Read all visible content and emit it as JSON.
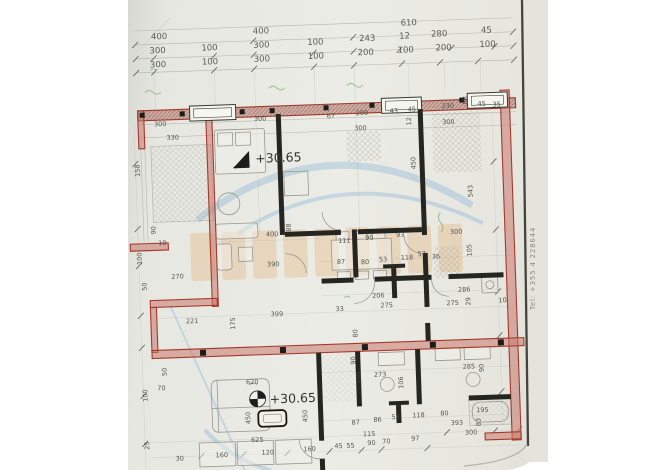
{
  "margin_note": {
    "text": "Tel: +355 4 228644"
  },
  "colors": {
    "wall_red": "#a4392c",
    "wall_black": "#262621",
    "paper": "#e9e9e3",
    "watermark_orange": "#e09a4e",
    "watermark_blue": "#6fa6cf",
    "green_mark": "#7aa571",
    "dimension_text": "#4a4a44"
  },
  "elevation_markers": [
    {
      "text": "+30.65",
      "x": 130,
      "y": 160
    },
    {
      "text": "+30.65",
      "x": 136,
      "y": 401
    }
  ],
  "plan_labels": [
    {
      "t": "400",
      "x": 30,
      "y": 33,
      "s": 9
    },
    {
      "t": "400",
      "x": 132,
      "y": 31,
      "s": 9
    },
    {
      "t": "610",
      "x": 280,
      "y": 28,
      "s": 9
    },
    {
      "t": "300",
      "x": 28,
      "y": 47,
      "s": 9
    },
    {
      "t": "100",
      "x": 80,
      "y": 46,
      "s": 9
    },
    {
      "t": "300",
      "x": 132,
      "y": 45,
      "s": 9
    },
    {
      "t": "100",
      "x": 186,
      "y": 44,
      "s": 9
    },
    {
      "t": "243",
      "x": 238,
      "y": 42,
      "s": 9
    },
    {
      "t": "12",
      "x": 278,
      "y": 41,
      "s": 9
    },
    {
      "t": "280",
      "x": 310,
      "y": 40,
      "s": 9
    },
    {
      "t": "45",
      "x": 360,
      "y": 38,
      "s": 9
    },
    {
      "t": "300",
      "x": 28,
      "y": 61,
      "s": 9
    },
    {
      "t": "100",
      "x": 80,
      "y": 60,
      "s": 9
    },
    {
      "t": "300",
      "x": 132,
      "y": 59,
      "s": 9
    },
    {
      "t": "100",
      "x": 186,
      "y": 58,
      "s": 9
    },
    {
      "t": "200",
      "x": 236,
      "y": 56,
      "s": 9
    },
    {
      "t": "100",
      "x": 276,
      "y": 55,
      "s": 9
    },
    {
      "t": "200",
      "x": 314,
      "y": 54,
      "s": 9
    },
    {
      "t": "100",
      "x": 358,
      "y": 52,
      "s": 9
    },
    {
      "t": "300",
      "x": 30,
      "y": 120
    },
    {
      "t": "330",
      "x": 42,
      "y": 134
    },
    {
      "t": "300",
      "x": 130,
      "y": 118
    },
    {
      "t": "67",
      "x": 203,
      "y": 118
    },
    {
      "t": "200",
      "x": 232,
      "y": 116
    },
    {
      "t": "43",
      "x": 266,
      "y": 115
    },
    {
      "t": "45",
      "x": 284,
      "y": 114
    },
    {
      "t": "230",
      "x": 318,
      "y": 112
    },
    {
      "t": "88",
      "x": 344,
      "y": 109,
      "v": true
    },
    {
      "t": "45",
      "x": 354,
      "y": 111
    },
    {
      "t": "35",
      "x": 369,
      "y": 112
    },
    {
      "t": "300",
      "x": 230,
      "y": 131
    },
    {
      "t": "12",
      "x": 287,
      "y": 128,
      "v": true
    },
    {
      "t": "300",
      "x": 318,
      "y": 128
    },
    {
      "t": "450",
      "x": 290,
      "y": 172,
      "v": true
    },
    {
      "t": "543",
      "x": 346,
      "y": 202,
      "v": true
    },
    {
      "t": "158",
      "x": 14,
      "y": 170,
      "v": true
    },
    {
      "t": "90",
      "x": 28,
      "y": 228,
      "v": true
    },
    {
      "t": "10",
      "x": 30,
      "y": 239
    },
    {
      "t": "100",
      "x": 13,
      "y": 258,
      "v": true
    },
    {
      "t": "270",
      "x": 42,
      "y": 273
    },
    {
      "t": "50",
      "x": 17,
      "y": 284,
      "v": true
    },
    {
      "t": "400",
      "x": 138,
      "y": 234
    },
    {
      "t": "88",
      "x": 163,
      "y": 230,
      "v": true
    },
    {
      "t": "390",
      "x": 138,
      "y": 264
    },
    {
      "t": "111",
      "x": 210,
      "y": 243
    },
    {
      "t": "90",
      "x": 237,
      "y": 241
    },
    {
      "t": "93",
      "x": 268,
      "y": 239
    },
    {
      "t": "300",
      "x": 322,
      "y": 238
    },
    {
      "t": "87",
      "x": 208,
      "y": 264
    },
    {
      "t": "80",
      "x": 232,
      "y": 265
    },
    {
      "t": "53",
      "x": 250,
      "y": 263
    },
    {
      "t": "118",
      "x": 272,
      "y": 262
    },
    {
      "t": "57",
      "x": 289,
      "y": 259
    },
    {
      "t": "36",
      "x": 303,
      "y": 262
    },
    {
      "t": "105",
      "x": 343,
      "y": 261,
      "v": true
    },
    {
      "t": "206",
      "x": 242,
      "y": 299
    },
    {
      "t": "275",
      "x": 250,
      "y": 309
    },
    {
      "t": "286",
      "x": 328,
      "y": 296
    },
    {
      "t": "275",
      "x": 316,
      "y": 309
    },
    {
      "t": "29",
      "x": 340,
      "y": 310,
      "v": true
    },
    {
      "t": "10",
      "x": 368,
      "y": 308
    },
    {
      "t": "33",
      "x": 205,
      "y": 311
    },
    {
      "t": "221",
      "x": 55,
      "y": 318
    },
    {
      "t": "399",
      "x": 140,
      "y": 314
    },
    {
      "t": "175",
      "x": 104,
      "y": 326,
      "v": true
    },
    {
      "t": "80",
      "x": 226,
      "y": 338,
      "v": true
    },
    {
      "t": "620",
      "x": 113,
      "y": 381
    },
    {
      "t": "450",
      "x": 116,
      "y": 421,
      "v": true
    },
    {
      "t": "450",
      "x": 173,
      "y": 421,
      "v": true
    },
    {
      "t": "625",
      "x": 116,
      "y": 439
    },
    {
      "t": "160",
      "x": 80,
      "y": 453
    },
    {
      "t": "120",
      "x": 126,
      "y": 452
    },
    {
      "t": "160",
      "x": 168,
      "y": 450
    },
    {
      "t": "45",
      "x": 199,
      "y": 448
    },
    {
      "t": "55",
      "x": 211,
      "y": 448
    },
    {
      "t": "90",
      "x": 232,
      "y": 446
    },
    {
      "t": "70",
      "x": 247,
      "y": 445
    },
    {
      "t": "97",
      "x": 276,
      "y": 443
    },
    {
      "t": "87",
      "x": 217,
      "y": 425
    },
    {
      "t": "86",
      "x": 239,
      "y": 423
    },
    {
      "t": "53",
      "x": 257,
      "y": 421
    },
    {
      "t": "115",
      "x": 228,
      "y": 437
    },
    {
      "t": "273",
      "x": 241,
      "y": 378
    },
    {
      "t": "200",
      "x": 228,
      "y": 385,
      "v": true
    },
    {
      "t": "106",
      "x": 270,
      "y": 391,
      "v": true
    },
    {
      "t": "285",
      "x": 330,
      "y": 373
    },
    {
      "t": "90",
      "x": 351,
      "y": 377,
      "v": true
    },
    {
      "t": "118",
      "x": 278,
      "y": 420
    },
    {
      "t": "80",
      "x": 306,
      "y": 419
    },
    {
      "t": "195",
      "x": 342,
      "y": 417
    },
    {
      "t": "393",
      "x": 316,
      "y": 429
    },
    {
      "t": "83",
      "x": 346,
      "y": 431,
      "v": true
    },
    {
      "t": "300",
      "x": 330,
      "y": 439
    },
    {
      "t": "50",
      "x": 34,
      "y": 370,
      "v": true
    },
    {
      "t": "70",
      "x": 24,
      "y": 384
    },
    {
      "t": "100",
      "x": 14,
      "y": 395,
      "v": true
    },
    {
      "t": "25",
      "x": 14,
      "y": 443,
      "v": true
    },
    {
      "t": "30",
      "x": 40,
      "y": 455
    },
    {
      "t": "90",
      "x": 223,
      "y": 365,
      "v": true
    }
  ]
}
